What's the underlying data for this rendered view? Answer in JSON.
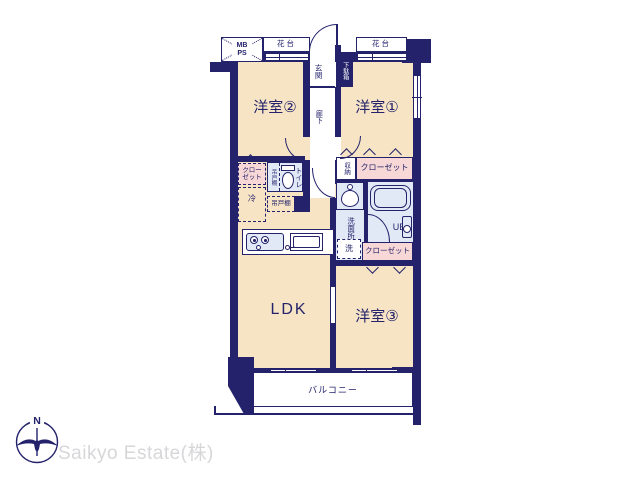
{
  "labels": {
    "room2": "洋室②",
    "room1": "洋室①",
    "room3": "洋室③",
    "ldk": "LDK",
    "entrance": "玄関",
    "hallway": "廊下",
    "shoe_cabinet": "下駄箱",
    "balcony": "バルコニー",
    "meter_box": "MB",
    "pipe_space": "PS",
    "flower_stand_left": "花台",
    "flower_stand_right": "花台",
    "closet_left_line1": "クロー",
    "closet_left_line2": "ゼット",
    "closet_top_right": "クローゼット",
    "closet_bottom_right": "クローゼット",
    "refrigerator": "冷",
    "hanging_cupboard_side": "吊戸棚",
    "hanging_cupboard": "吊戸棚",
    "toilet": "トイレ",
    "storage": "収納",
    "washroom": "洗面所",
    "washing_machine": "洗",
    "unit_bath": "UB"
  },
  "branding": {
    "compass_north": "N",
    "company": "Saikyo Estate(株)"
  },
  "colors": {
    "wall_navy": "#23226B",
    "room_beige": "#F6E4C5",
    "closet_pink": "#F8D8D6",
    "wet_blue": "#E2E9F6",
    "logo_gray": "#D7D7DA",
    "background": "#FFFFFF"
  }
}
